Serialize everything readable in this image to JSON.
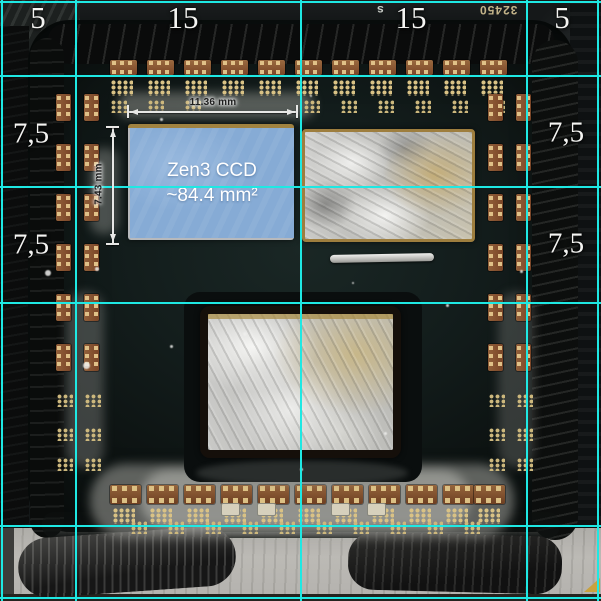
{
  "annotations": {
    "grid": {
      "color": "#1ee8e3",
      "v_lines": [
        1,
        75,
        300,
        526,
        597
      ],
      "h_lines": [
        1,
        75,
        186,
        302,
        525,
        597
      ]
    },
    "top_scale_labels": [
      {
        "text": "5",
        "x": 38
      },
      {
        "text": "15",
        "x": 183
      },
      {
        "text": "15",
        "x": 411
      },
      {
        "text": "5",
        "x": 562
      }
    ],
    "left_scale_labels": [
      {
        "text": "7,5",
        "y": 134
      },
      {
        "text": "7,5",
        "y": 245
      }
    ],
    "right_scale_labels": [
      {
        "text": "7,5",
        "y": 133
      },
      {
        "text": "7,5",
        "y": 244
      }
    ],
    "die_highlight": {
      "line1": "Zen3 CCD",
      "line2": "~84.4 mm²",
      "width_label": "11.36 mm",
      "height_label": "7.43 mm",
      "fill_color": "#86abd5"
    }
  },
  "photo": {
    "silkscreen_number": "32450",
    "silkscreen_letter": "s",
    "components": {
      "top_chips": {
        "y": 60,
        "xs": [
          110,
          147,
          184,
          221,
          258,
          295,
          332,
          369,
          406,
          443,
          480
        ]
      },
      "top_pad_grids": {
        "y": 80,
        "xs": [
          111,
          148,
          185,
          222,
          259,
          296,
          333,
          370,
          407,
          444,
          481
        ]
      },
      "top_pad_grids_small": {
        "y": 100,
        "xs": [
          111,
          148,
          185,
          304,
          341,
          378,
          415,
          452,
          489
        ]
      },
      "left_chips_v": {
        "cols": [
          56,
          84
        ],
        "ys": [
          94,
          144,
          194,
          244,
          294,
          344
        ]
      },
      "left_pad_grids": {
        "cols": [
          57,
          85
        ],
        "ys": [
          394,
          428,
          458
        ]
      },
      "right_chips_v": {
        "cols": [
          488,
          516
        ],
        "ys": [
          94,
          144,
          194,
          244,
          294,
          344
        ]
      },
      "right_pad_grids": {
        "cols": [
          489,
          517
        ],
        "ys": [
          394,
          428,
          458
        ]
      },
      "bottom_caps": {
        "y": 485,
        "xs": [
          110,
          147,
          184,
          221,
          258,
          295,
          332,
          369,
          406,
          443,
          474
        ]
      },
      "bottom_pad_grids": {
        "y": 508,
        "xs": [
          113,
          150,
          187,
          224,
          261,
          298,
          335,
          372,
          409,
          446,
          478
        ]
      },
      "bottom_pad_grids_small": {
        "y": 521,
        "xs": [
          131,
          168,
          205,
          242,
          279,
          316,
          353,
          390,
          427,
          464
        ]
      },
      "white_chips": [
        [
          222,
          504
        ],
        [
          258,
          504
        ],
        [
          332,
          504
        ],
        [
          368,
          504
        ]
      ]
    },
    "specks": [
      [
        170,
        345,
        3
      ],
      [
        243,
        332,
        4
      ],
      [
        300,
        468,
        3
      ],
      [
        384,
        432,
        3
      ],
      [
        446,
        304,
        3
      ],
      [
        352,
        282,
        2
      ],
      [
        95,
        267,
        4
      ],
      [
        83,
        362,
        7
      ],
      [
        520,
        270,
        3
      ],
      [
        160,
        118,
        3
      ],
      [
        45,
        270,
        6
      ],
      [
        310,
        95,
        2
      ]
    ]
  }
}
